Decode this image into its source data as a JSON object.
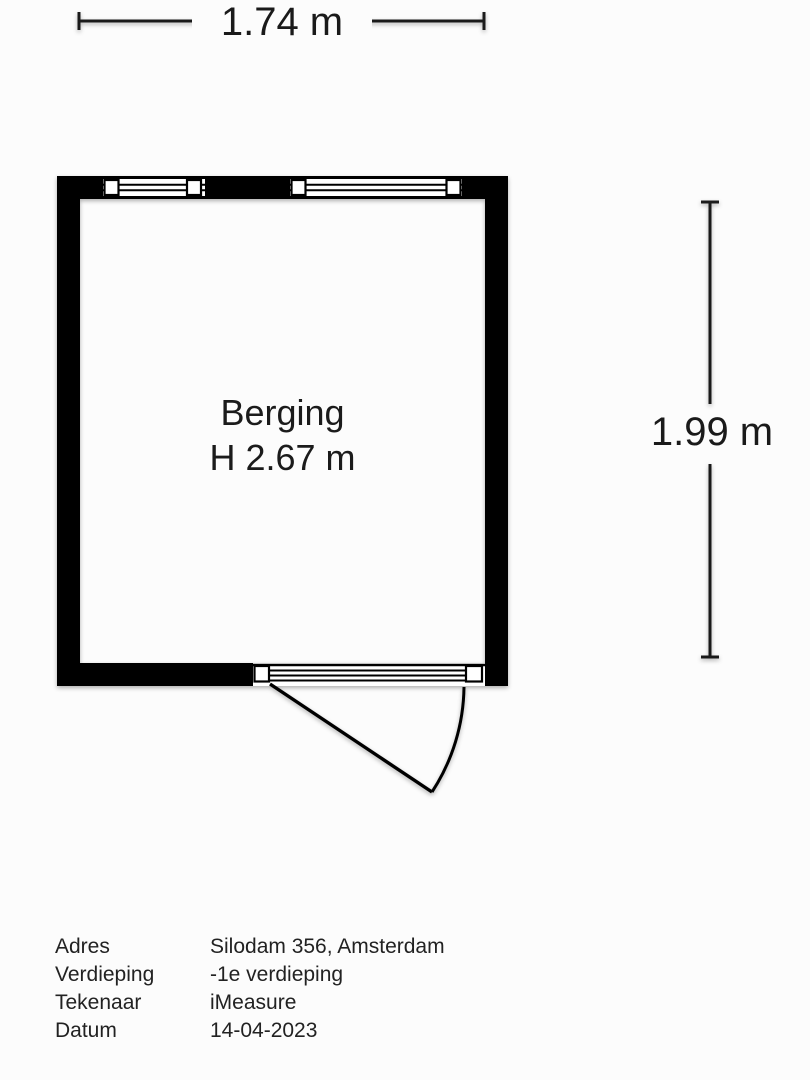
{
  "colors": {
    "wall": "#000000",
    "line": "#1a1a1a",
    "text": "#1d1d1d",
    "background": "#fcfcfc"
  },
  "floorplan": {
    "room": {
      "name": "Berging",
      "ceiling_height": "H 2.67 m"
    },
    "dimensions": {
      "width": "1.74 m",
      "height": "1.99 m"
    },
    "features": [
      "window-top-left",
      "window-top-right",
      "door-with-sidelight-bottom"
    ]
  },
  "info_table": {
    "rows": [
      {
        "label": "Adres",
        "value": "Silodam 356, Amsterdam"
      },
      {
        "label": "Verdieping",
        "value": "-1e verdieping"
      },
      {
        "label": "Tekenaar",
        "value": "iMeasure"
      },
      {
        "label": "Datum",
        "value": "14-04-2023"
      }
    ]
  }
}
